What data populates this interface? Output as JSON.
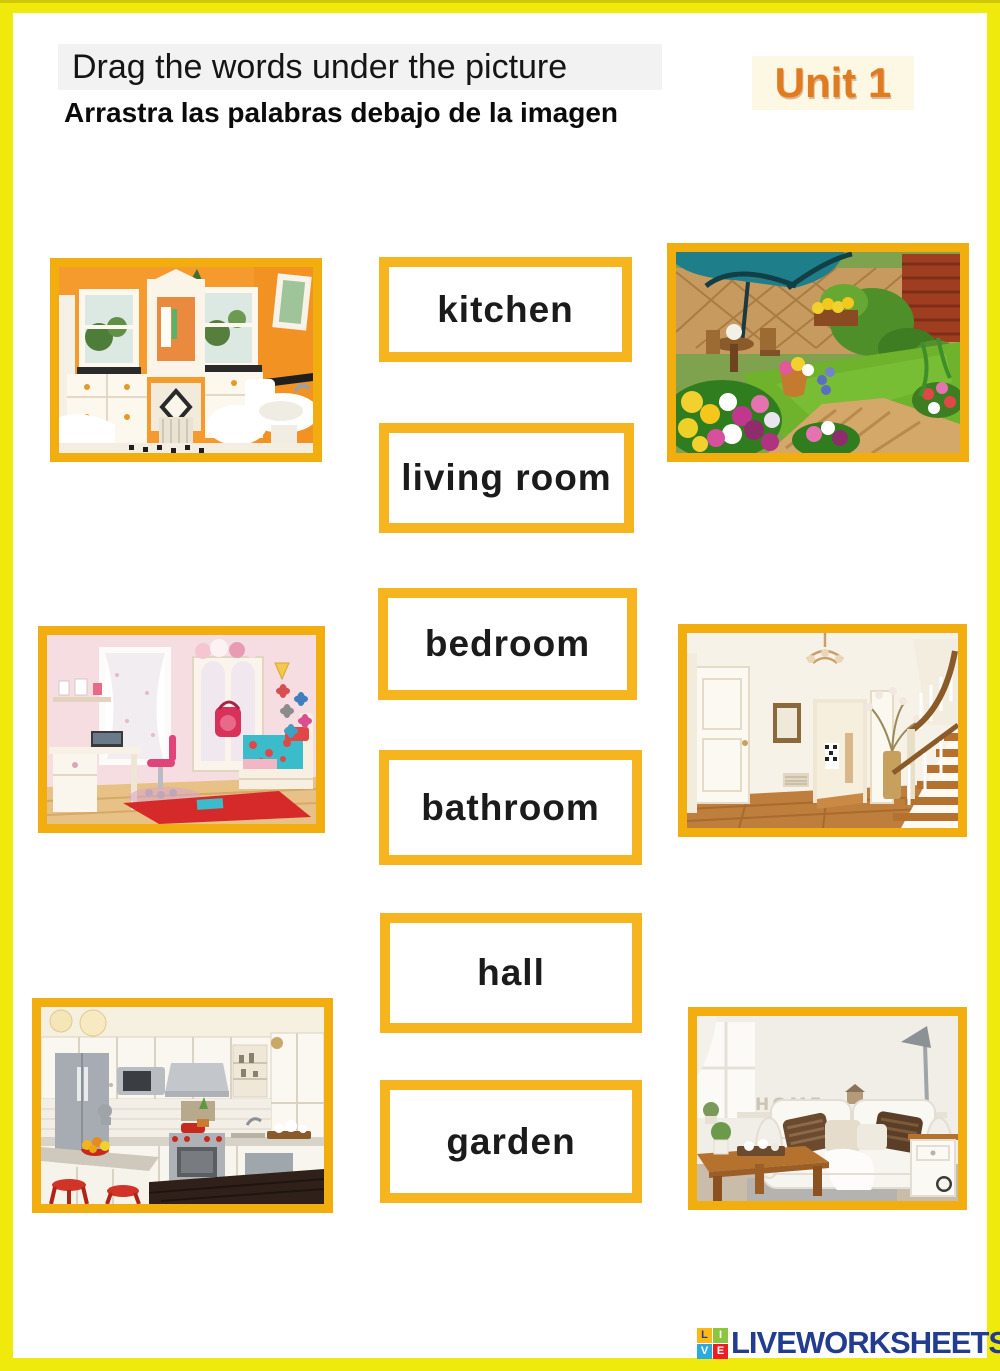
{
  "colors": {
    "page_yellow": "#F0E90C",
    "frame_gold": "#F2AE0E",
    "word_border": "#F6B51F",
    "unit_orange": "#E07C1F",
    "logo_blue": "#223C8F"
  },
  "header": {
    "title": "Drag the words under the picture",
    "subtitle": "Arrastra las palabras debajo de la imagen",
    "unit_label": "Unit 1"
  },
  "words": [
    {
      "label": "kitchen"
    },
    {
      "label": "living room"
    },
    {
      "label": "bedroom"
    },
    {
      "label": "bathroom"
    },
    {
      "label": "hall"
    },
    {
      "label": "garden"
    }
  ],
  "pictures": [
    {
      "name": "bathroom"
    },
    {
      "name": "garden"
    },
    {
      "name": "bedroom"
    },
    {
      "name": "hall"
    },
    {
      "name": "kitchen"
    },
    {
      "name": "living room",
      "decor_text": "HOME"
    }
  ],
  "footer": {
    "logo_text": "LIVEWORKSHEETS",
    "logo_blocks": [
      {
        "letter": "L",
        "bg": "#FDB913",
        "fg": "#2B3990"
      },
      {
        "letter": "I",
        "bg": "#8CC63F",
        "fg": "#FFFFFF"
      },
      {
        "letter": "V",
        "bg": "#29ABE2",
        "fg": "#FFFFFF"
      },
      {
        "letter": "E",
        "bg": "#ED1C24",
        "fg": "#FFFFFF"
      }
    ]
  }
}
